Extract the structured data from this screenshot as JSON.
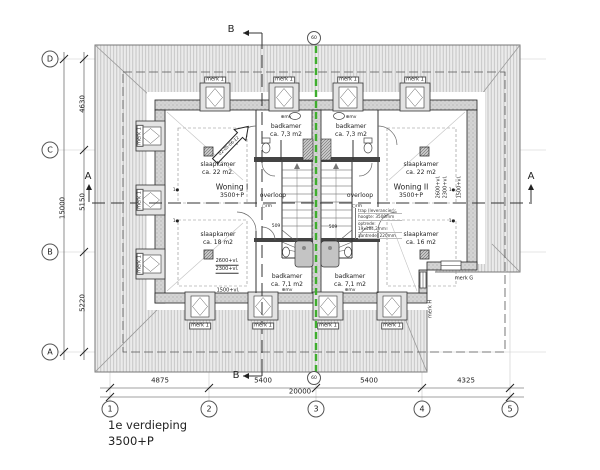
{
  "title": {
    "line1": "1e verdieping",
    "line2": "3500+P"
  },
  "grid": {
    "columns": [
      "1",
      "2",
      "3",
      "4",
      "5"
    ],
    "rows": [
      "D",
      "C",
      "B",
      "A"
    ],
    "detail_bubble": "60"
  },
  "dimensions": {
    "bottom_segments": [
      "4875",
      "5400",
      "5400",
      "4325"
    ],
    "bottom_total": "20000",
    "left_segments": [
      "4630",
      "5150",
      "5220"
    ],
    "left_total": "15000"
  },
  "sections": {
    "a_label": "A",
    "b_label": "B"
  },
  "woning1": {
    "name": "Woning I",
    "level": "3500+P",
    "bedroom_top_label": "slaapkamer",
    "bedroom_top_area": "ca. 22 m2.",
    "bedroom_bottom_label": "slaapkamer",
    "bedroom_bottom_area": "ca. 18 m2",
    "bathroom_top_label": "badkamer",
    "bathroom_top_area": "ca. 7,3 m2",
    "bathroom_bottom_label": "badkamer",
    "bathroom_bottom_area": "ca. 7,1 m2",
    "landing_label": "overloop"
  },
  "woning2": {
    "name": "Woning II",
    "level": "3500+P",
    "bedroom_top_label": "slaapkamer",
    "bedroom_top_area": "ca. 22 m2",
    "bedroom_bottom_label": "slaapkamer",
    "bedroom_bottom_area": "ca. 16 m2",
    "bathroom_top_label": "badkamer",
    "bathroom_top_area": "ca. 7,3 m2",
    "bathroom_bottom_label": "badkamer",
    "bathroom_bottom_area": "ca. 7,1 m2",
    "landing_label": "overloop"
  },
  "marks": {
    "dormer_window": "merk 1",
    "window_g": "merk G",
    "window_h": "merk H"
  },
  "annotations": {
    "height_2600": "2600+vl.",
    "height_2300": "2300+vl.",
    "height_1500": "1500+vl.",
    "stair_width": "509",
    "smoke_icon": "○",
    "smoke_detector": "rm",
    "vent": "⊕mv",
    "door_tag": "1●",
    "detail_arrow_code": "02-05-06-12",
    "stair_note": [
      "trap (leverancier):",
      "hoogte: 3500mm",
      "optrede: 19x184,2mm",
      "aantrede: 220mm"
    ]
  },
  "colors": {
    "party_wall_axis": "#3fae2e",
    "roof_fill": "#ebebeb",
    "roof_hatch_line": "#bcbcbc",
    "wall_fill": "#d4d4d4"
  }
}
